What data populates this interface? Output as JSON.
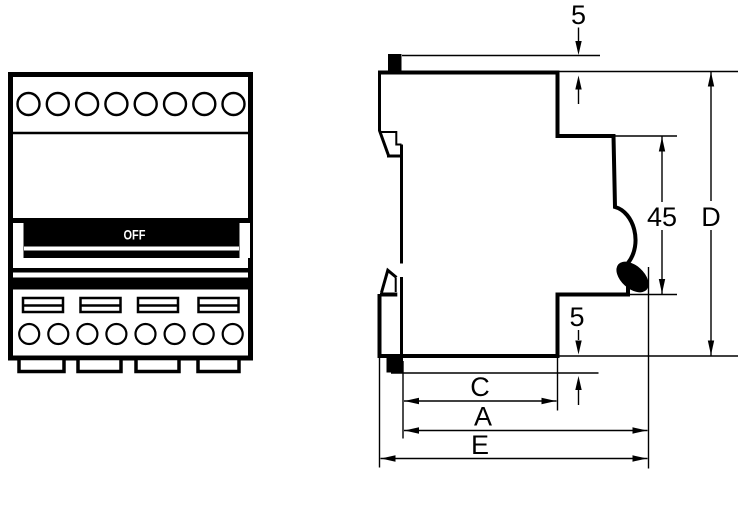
{
  "drawing_title": "Modular circuit breaker outline drawing",
  "front_view": {
    "switch_state_label": "OFF"
  },
  "dimensions": {
    "top_clearance": {
      "label": "5"
    },
    "front_projection_height": {
      "label": "45"
    },
    "overall_height": {
      "label": "D"
    },
    "bottom_clearance": {
      "label": "5"
    },
    "width_c": {
      "label": "C"
    },
    "width_a": {
      "label": "A"
    },
    "width_e": {
      "label": "E"
    }
  },
  "colors": {
    "ink": "#000000",
    "paper": "#ffffff"
  }
}
